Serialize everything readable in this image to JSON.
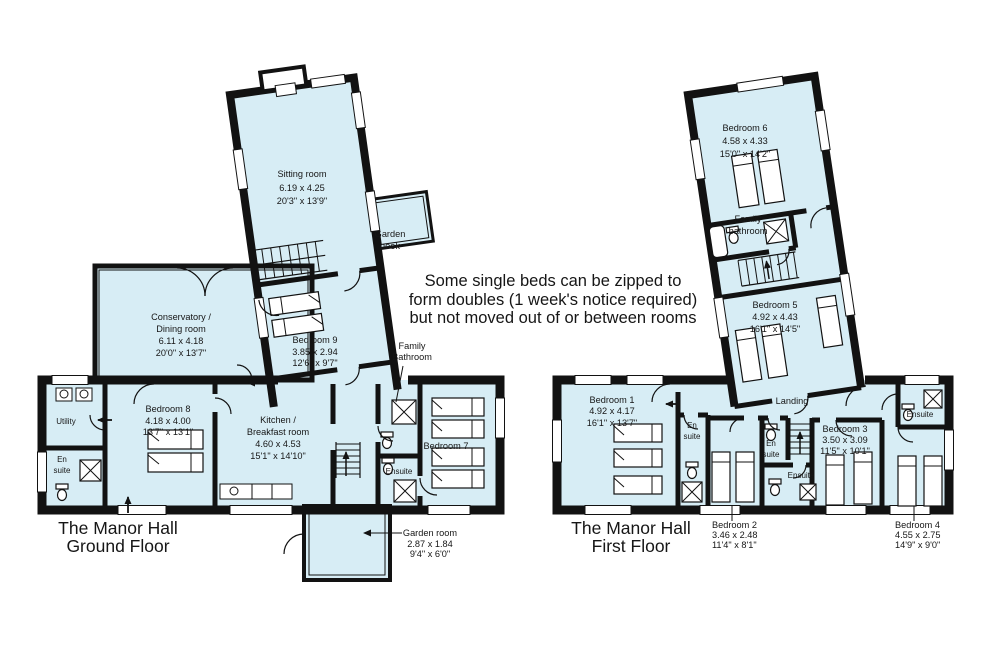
{
  "colors": {
    "room_fill": "#d7edf5",
    "wall": "#121212",
    "background": "#ffffff"
  },
  "note": [
    "Some single beds can be zipped to",
    "form doubles (1 week's notice required)",
    "but not moved out of or between rooms"
  ],
  "ground_floor": {
    "title": [
      "The Manor Hall",
      "Ground Floor"
    ],
    "rooms": {
      "sitting_room": {
        "name": "Sitting room",
        "metric": "6.19 x 4.25",
        "imperial": "20'3\" x 13'9\""
      },
      "garden_nook": {
        "name": [
          "Garden",
          "nook"
        ]
      },
      "conservatory": {
        "name": [
          "Conservatory /",
          "Dining room"
        ],
        "metric": "6.11 x 4.18",
        "imperial": "20'0\" x 13'7\""
      },
      "bedroom_9": {
        "name": "Bedroom 9",
        "metric": "3.85 x 2.94",
        "imperial": "12'6\" x 9'7\""
      },
      "family_bathroom": {
        "name": [
          "Family",
          "Bathroom"
        ]
      },
      "bedroom_8": {
        "name": "Bedroom 8",
        "metric": "4.18 x 4.00",
        "imperial": "13'7\" x 13'1\""
      },
      "utility": {
        "name": "Utility"
      },
      "en_suite": {
        "name": [
          "En",
          "suite"
        ]
      },
      "kitchen": {
        "name": [
          "Kitchen /",
          "Breakfast room"
        ],
        "metric": "4.60 x 4.53",
        "imperial": "15'1\" x 14'10\""
      },
      "ensuite": {
        "name": "Ensuite"
      },
      "bedroom_7": {
        "name": "Bedroom 7"
      },
      "garden_room": {
        "name": "Garden room",
        "metric": "2.87 x 1.84",
        "imperial": "9'4\" x 6'0\""
      }
    }
  },
  "first_floor": {
    "title": [
      "The Manor Hall",
      "First Floor"
    ],
    "rooms": {
      "bedroom_6": {
        "name": "Bedroom 6",
        "metric": "4.58 x 4.33",
        "imperial": "15'0\" x 14'2\""
      },
      "family_bathroom": {
        "name": [
          "Family",
          "bathroom"
        ]
      },
      "bedroom_5": {
        "name": "Bedroom 5",
        "metric": "4.92 x 4.43",
        "imperial": "16'1\" x 14'5\""
      },
      "bedroom_1": {
        "name": "Bedroom 1",
        "metric": "4.92 x 4.17",
        "imperial": "16'1\" x 13'7\""
      },
      "en_suite_1": {
        "name": [
          "En",
          "suite"
        ]
      },
      "landing": {
        "name": "Landing"
      },
      "en_suite_2": {
        "name": [
          "En",
          "suite"
        ]
      },
      "ensuite_3": {
        "name": "Ensuite"
      },
      "bedroom_3": {
        "name": "Bedroom 3",
        "metric": "3.50 x 3.09",
        "imperial": "11'5\" x 10'1\""
      },
      "bedroom_2": {
        "name": "Bedroom 2",
        "metric": "3.46 x 2.48",
        "imperial": "11'4\" x 8'1\""
      },
      "bedroom_4": {
        "name": "Bedroom 4",
        "metric": "4.55 x 2.75",
        "imperial": "14'9\" x 9'0\""
      },
      "ensuite_4": {
        "name": "Ensuite"
      }
    }
  }
}
